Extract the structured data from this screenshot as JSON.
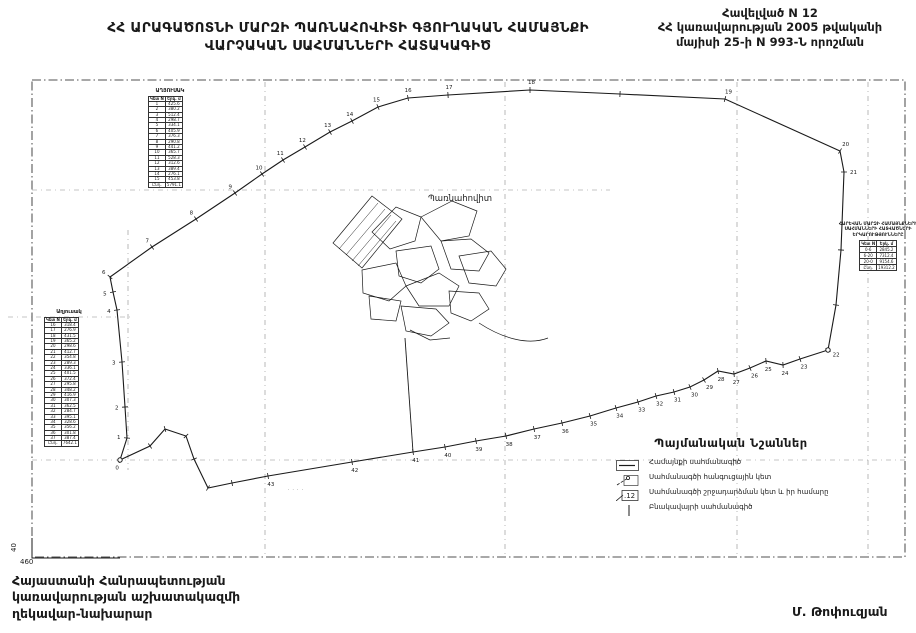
{
  "header": {
    "title_line1": "ՀՀ ԱՐԱԳԱԾՈՏՆԻ ՄԱՐԶԻ ՊԱՌՆԱՀՈՎԻՏԻ ԳՅՈՒՂԱԿԱՆ ՀԱՄԱՅՆՔԻ",
    "title_line2": "ՎԱՐՉԱԿԱՆ  ՍԱՀՄԱՆՆԵՐԻ ՀԱՏԱԿԱԳԻԾ",
    "annex_line1": "Հավելված N 12",
    "annex_line2": "ՀՀ կառավարության 2005 թվականի",
    "annex_line3": "մայիսի 25-ի N 993-Ն որոշման"
  },
  "footer": {
    "line1": "Հայաստանի Հանրապետության",
    "line2": "կառավարության աշխատակազմի",
    "line3": "ղեկավար-նախարար",
    "signature": "Մ. Թոփուզյան"
  },
  "legend": {
    "title": "Պայմանական Նշաններ",
    "items": [
      {
        "sym": "boundary-line",
        "label": "Համայնքի սահմանագիծ"
      },
      {
        "sym": "junction-point",
        "label": "Սահմանագծի հանգուցային կետ"
      },
      {
        "sym": "turn-point",
        "label": "Սահմանագծի շրջադարձման կետ և իր համարը"
      },
      {
        "sym": "settlement-line",
        "label": "Բնակավայրի սահմանագիծ"
      }
    ]
  },
  "tables": {
    "mini": {
      "title": "ԱՂՅՈՒՍԱԿ",
      "headers": [
        "Կետ N",
        "Երկ. մ"
      ],
      "rows": [
        [
          "1",
          "425.6"
        ],
        [
          "2",
          "380.2"
        ],
        [
          "3",
          "512.4"
        ],
        [
          "4",
          "298.7"
        ],
        [
          "5",
          "334.1"
        ],
        [
          "6",
          "405.9"
        ],
        [
          "7",
          "376.3"
        ],
        [
          "8",
          "290.8"
        ],
        [
          "9",
          "441.2"
        ],
        [
          "10",
          "365.7"
        ],
        [
          "11",
          "528.3"
        ],
        [
          "12",
          "312.6"
        ],
        [
          "13",
          "389.4"
        ],
        [
          "14",
          "276.1"
        ],
        [
          "15",
          "453.8"
        ]
      ],
      "total": [
        "Ընդ.",
        "5791.1"
      ]
    },
    "left": {
      "title": "Աղյուսակ",
      "headers": [
        "Կետ N",
        "Երկ. մ"
      ],
      "rows": [
        [
          "16",
          "318.4"
        ],
        [
          "17",
          "276.9"
        ],
        [
          "18",
          "431.5"
        ],
        [
          "19",
          "365.2"
        ],
        [
          "20",
          "298.6"
        ],
        [
          "21",
          "412.7"
        ],
        [
          "22",
          "354.8"
        ],
        [
          "23",
          "289.3"
        ],
        [
          "24",
          "336.1"
        ],
        [
          "25",
          "401.5"
        ],
        [
          "26",
          "372.4"
        ],
        [
          "27",
          "295.8"
        ],
        [
          "28",
          "348.2"
        ],
        [
          "29",
          "416.9"
        ],
        [
          "30",
          "307.3"
        ],
        [
          "31",
          "362.5"
        ],
        [
          "32",
          "284.7"
        ],
        [
          "33",
          "395.1"
        ],
        [
          "34",
          "328.6"
        ],
        [
          "35",
          "356.2"
        ],
        [
          "36",
          "301.8"
        ],
        [
          "37",
          "387.4"
        ]
      ],
      "total": [
        "Ընդ.",
        "7642.1"
      ]
    },
    "right": {
      "lines": [
        "ՀԱՐԵՎԱՆ ՄԱՐԶԻ ՀԱՄԱՅՆՔՆԵՐԻ",
        "ՍԱՀՄԱՆՆԵՐԻ ՀԱՏՎԱԾՆԵՐԻ",
        "ԵՐԿԱՐՈՒԹՅՈՒՆՆԵՐԸ"
      ],
      "headers": [
        "Կետ N",
        "Երկ. մ"
      ],
      "rows": [
        [
          "0-6",
          "2845.2"
        ],
        [
          "6-20",
          "7312.4"
        ],
        [
          "20-0",
          "9154.6"
        ]
      ],
      "total": [
        "Ընդ.",
        "19312.2"
      ]
    }
  },
  "map": {
    "village_label": "Պառնահովիտ",
    "small_label": "· · · ·",
    "corner_label": "460",
    "axis_label": "40",
    "line_color": "#1a1a1a",
    "grid_color": "#8a8a8a",
    "frame": {
      "x": 32,
      "y": 80,
      "w": 873,
      "h": 477
    },
    "grid_verticals": [
      {
        "x": 128,
        "y1": 230,
        "y2": 470
      },
      {
        "x": 265,
        "y1": 82,
        "y2": 556
      },
      {
        "x": 505,
        "y1": 82,
        "y2": 556
      },
      {
        "x": 737,
        "y1": 82,
        "y2": 556
      },
      {
        "x": 868,
        "y1": 82,
        "y2": 556
      }
    ],
    "grid_horizontals": [
      {
        "y": 190,
        "x1": 32,
        "x2": 610
      },
      {
        "y": 317,
        "x1": 8,
        "x2": 132
      },
      {
        "y": 460,
        "x1": 32,
        "x2": 905
      }
    ],
    "boundary_points": [
      {
        "n": "0",
        "x": 120,
        "y": 460,
        "junction": true
      },
      {
        "n": "1",
        "x": 127,
        "y": 438
      },
      {
        "n": "2",
        "x": 125,
        "y": 407
      },
      {
        "n": "3",
        "x": 122,
        "y": 362
      },
      {
        "n": "4",
        "x": 117,
        "y": 310
      },
      {
        "n": "5",
        "x": 113,
        "y": 292
      },
      {
        "n": "6",
        "x": 110,
        "y": 277
      },
      {
        "n": "7",
        "x": 152,
        "y": 247
      },
      {
        "n": "8",
        "x": 196,
        "y": 219
      },
      {
        "n": "9",
        "x": 235,
        "y": 193
      },
      {
        "n": "10",
        "x": 262,
        "y": 174
      },
      {
        "n": "11",
        "x": 283,
        "y": 160
      },
      {
        "n": "12",
        "x": 305,
        "y": 147
      },
      {
        "n": "13",
        "x": 330,
        "y": 132
      },
      {
        "n": "14",
        "x": 352,
        "y": 121
      },
      {
        "n": "15",
        "x": 378,
        "y": 107
      },
      {
        "n": "16",
        "x": 408,
        "y": 98
      },
      {
        "n": "17",
        "x": 448,
        "y": 95
      },
      {
        "n": "18",
        "x": 530,
        "y": 90
      },
      {
        "x": 620,
        "y": 94
      },
      {
        "n": "19",
        "x": 725,
        "y": 99
      },
      {
        "n": "20",
        "x": 840,
        "y": 151
      },
      {
        "n": "21",
        "x": 844,
        "y": 172
      },
      {
        "x": 841,
        "y": 250
      },
      {
        "x": 836,
        "y": 305
      },
      {
        "n": "22",
        "x": 828,
        "y": 350,
        "junction": true
      },
      {
        "n": "23",
        "x": 800,
        "y": 359
      },
      {
        "n": "24",
        "x": 783,
        "y": 365
      },
      {
        "n": "25",
        "x": 766,
        "y": 361
      },
      {
        "n": "26",
        "x": 750,
        "y": 368
      },
      {
        "n": "27",
        "x": 734,
        "y": 374
      },
      {
        "n": "28",
        "x": 718,
        "y": 371
      },
      {
        "n": "29",
        "x": 704,
        "y": 380
      },
      {
        "n": "30",
        "x": 690,
        "y": 387
      },
      {
        "n": "31",
        "x": 674,
        "y": 392
      },
      {
        "n": "32",
        "x": 656,
        "y": 396
      },
      {
        "n": "33",
        "x": 638,
        "y": 402
      },
      {
        "n": "34",
        "x": 616,
        "y": 408
      },
      {
        "n": "35",
        "x": 590,
        "y": 416
      },
      {
        "n": "36",
        "x": 562,
        "y": 423
      },
      {
        "n": "37",
        "x": 534,
        "y": 429
      },
      {
        "n": "38",
        "x": 506,
        "y": 436
      },
      {
        "n": "39",
        "x": 476,
        "y": 441
      },
      {
        "n": "40",
        "x": 445,
        "y": 447
      },
      {
        "n": "41",
        "x": 413,
        "y": 452
      },
      {
        "n": "42",
        "x": 352,
        "y": 462
      },
      {
        "n": "43",
        "x": 268,
        "y": 476
      },
      {
        "x": 232,
        "y": 483
      },
      {
        "x": 208,
        "y": 488
      },
      {
        "x": 194,
        "y": 459
      },
      {
        "x": 186,
        "y": 436
      },
      {
        "x": 165,
        "y": 429
      },
      {
        "x": 150,
        "y": 446
      }
    ],
    "village_road": [
      [
        405,
        338
      ],
      [
        409,
        395
      ],
      [
        413,
        452
      ]
    ],
    "village_outline": "M333,243 L372,196 L402,219 L362,268 Z",
    "village_hatch": [
      [
        339,
        249,
        378,
        203
      ],
      [
        346,
        255,
        385,
        209
      ],
      [
        352,
        261,
        391,
        215
      ],
      [
        358,
        266,
        396,
        221
      ]
    ],
    "village_paths": [
      "M372,232 L396,207 L421,217 L415,241 L390,249 Z",
      "M421,217 L452,201 L477,211 L469,236 L441,241 Z",
      "M441,241 L471,239 L489,253 L479,271 L451,269 Z",
      "M396,251 L431,246 L439,269 L421,283 L399,276 Z",
      "M362,270 L396,263 L406,286 L389,301 L363,293 Z",
      "M406,286 L439,273 L459,286 L449,306 L419,306 Z",
      "M459,256 L491,251 L506,269 L496,286 L469,283 Z",
      "M369,296 L401,301 L396,321 L371,319 Z",
      "M401,306 L436,309 L449,323 L431,336 L406,331 Z",
      "M449,291 L479,293 L489,309 L471,321 L451,313 Z",
      "M479,323 C505,340 530,345 548,338",
      "M410,330 L430,340 L450,338"
    ]
  }
}
